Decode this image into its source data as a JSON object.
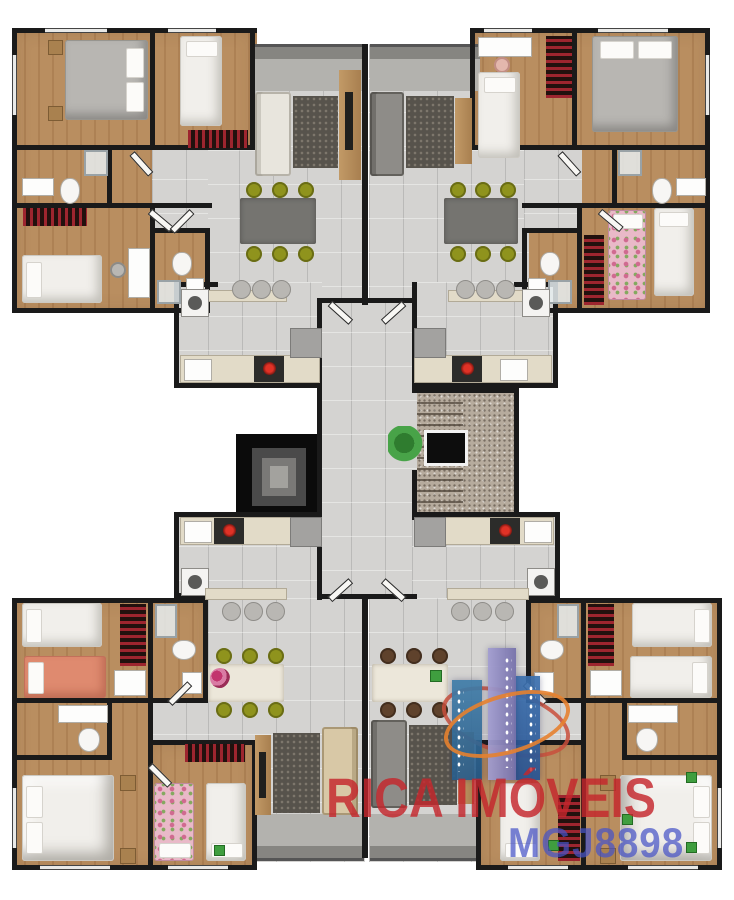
{
  "scene": {
    "kind": "3D-rendered residential floor plan, top-down view",
    "units": 4,
    "core": "central staircase and elevator shaft",
    "background": "#ffffff"
  },
  "watermark": {
    "brand": "RICA IMÓVEIS",
    "registration": "MGJ8898",
    "brand_color": "#c4262c",
    "registration_color": "#4653c6"
  },
  "logo": {
    "name": "rica-imoveis-building-logo",
    "tower_colors": [
      "#3c7ca8",
      "#908cc4",
      "#3a6fae"
    ],
    "orbit_colors": [
      "#e6812f",
      "#c94f3c"
    ],
    "window_dot_color": "#ffffff"
  },
  "palette": {
    "wall": "#1a1a1a",
    "wood_floor": "#b2875b",
    "tile_floor": "#d4d3d1",
    "balcony_concrete": "#a7a6a2",
    "stair_granite": "#b6ab9d",
    "rug_dark": "#57534c",
    "sofa_beige": "#d8c8a6",
    "sofa_gray": "#8e8c88",
    "bed_white": "#f1efeb",
    "bed_gray": "#b8b6b2",
    "bed_coral": "#df8a6f",
    "bed_floral": "#e9b9c8",
    "chair_olive": "#8f931d",
    "chair_brown": "#5f422c",
    "bookshelf_red": "#7c2027",
    "counter_beige": "#e2dbc8",
    "stove_burner_red": "#cc2a22",
    "plant_green": "#3f9e3f"
  }
}
